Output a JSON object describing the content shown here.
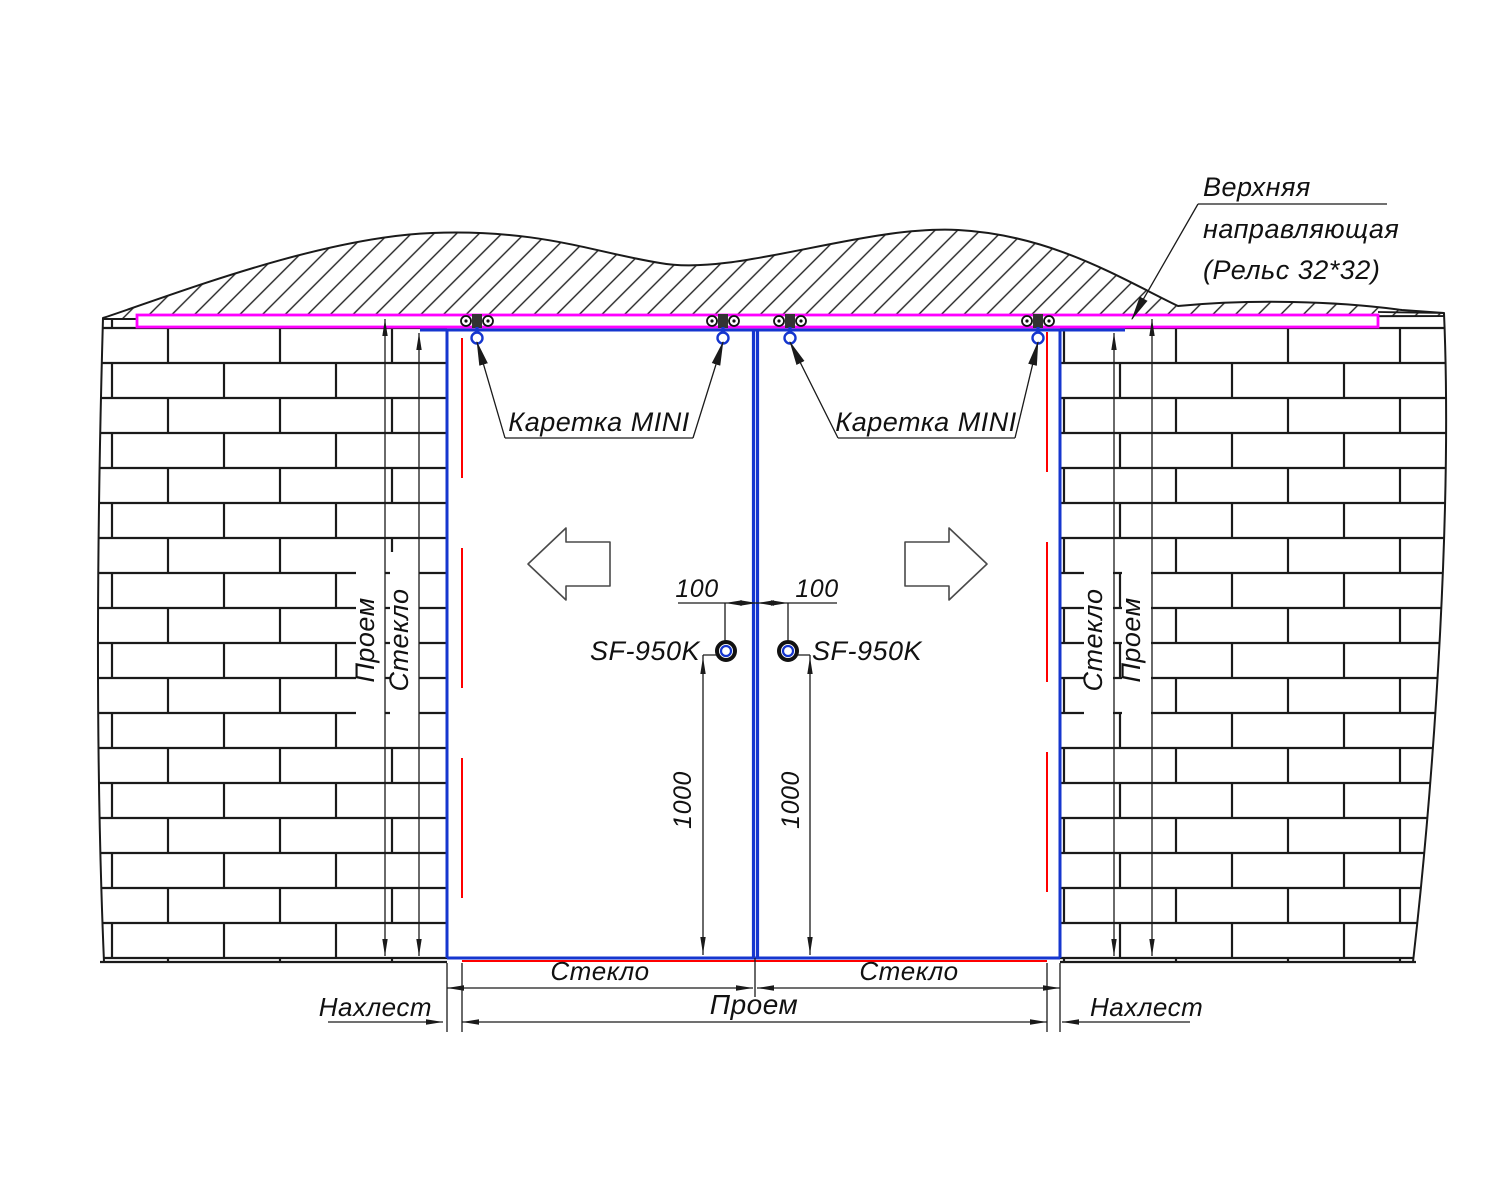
{
  "drawing": {
    "top_note": {
      "line1": "Верхняя",
      "line2": "направляющая",
      "line3": "(Рельс 32*32)"
    },
    "labels": {
      "carriage_left": "Каретка MINI",
      "carriage_right": "Каретка MINI",
      "knob_left": "SF-950K",
      "knob_right": "SF-950K"
    },
    "dimensions": {
      "knob_offset_left": "100",
      "knob_offset_right": "100",
      "knob_height_left": "1000",
      "knob_height_right": "1000",
      "side_left": {
        "opening": "Проем",
        "glass": "Стекло"
      },
      "side_right": {
        "glass": "Стекло",
        "opening": "Проем"
      },
      "bottom": {
        "glass_left": "Стекло",
        "glass_right": "Стекло",
        "opening": "Проем",
        "overlap_left": "Нахлест",
        "overlap_right": "Нахлест"
      }
    },
    "colors": {
      "rail": "#ff00ff",
      "glass_edge": "#1536cf",
      "opening_edge": "#ff0000",
      "ink": "#1a1a1a"
    }
  }
}
